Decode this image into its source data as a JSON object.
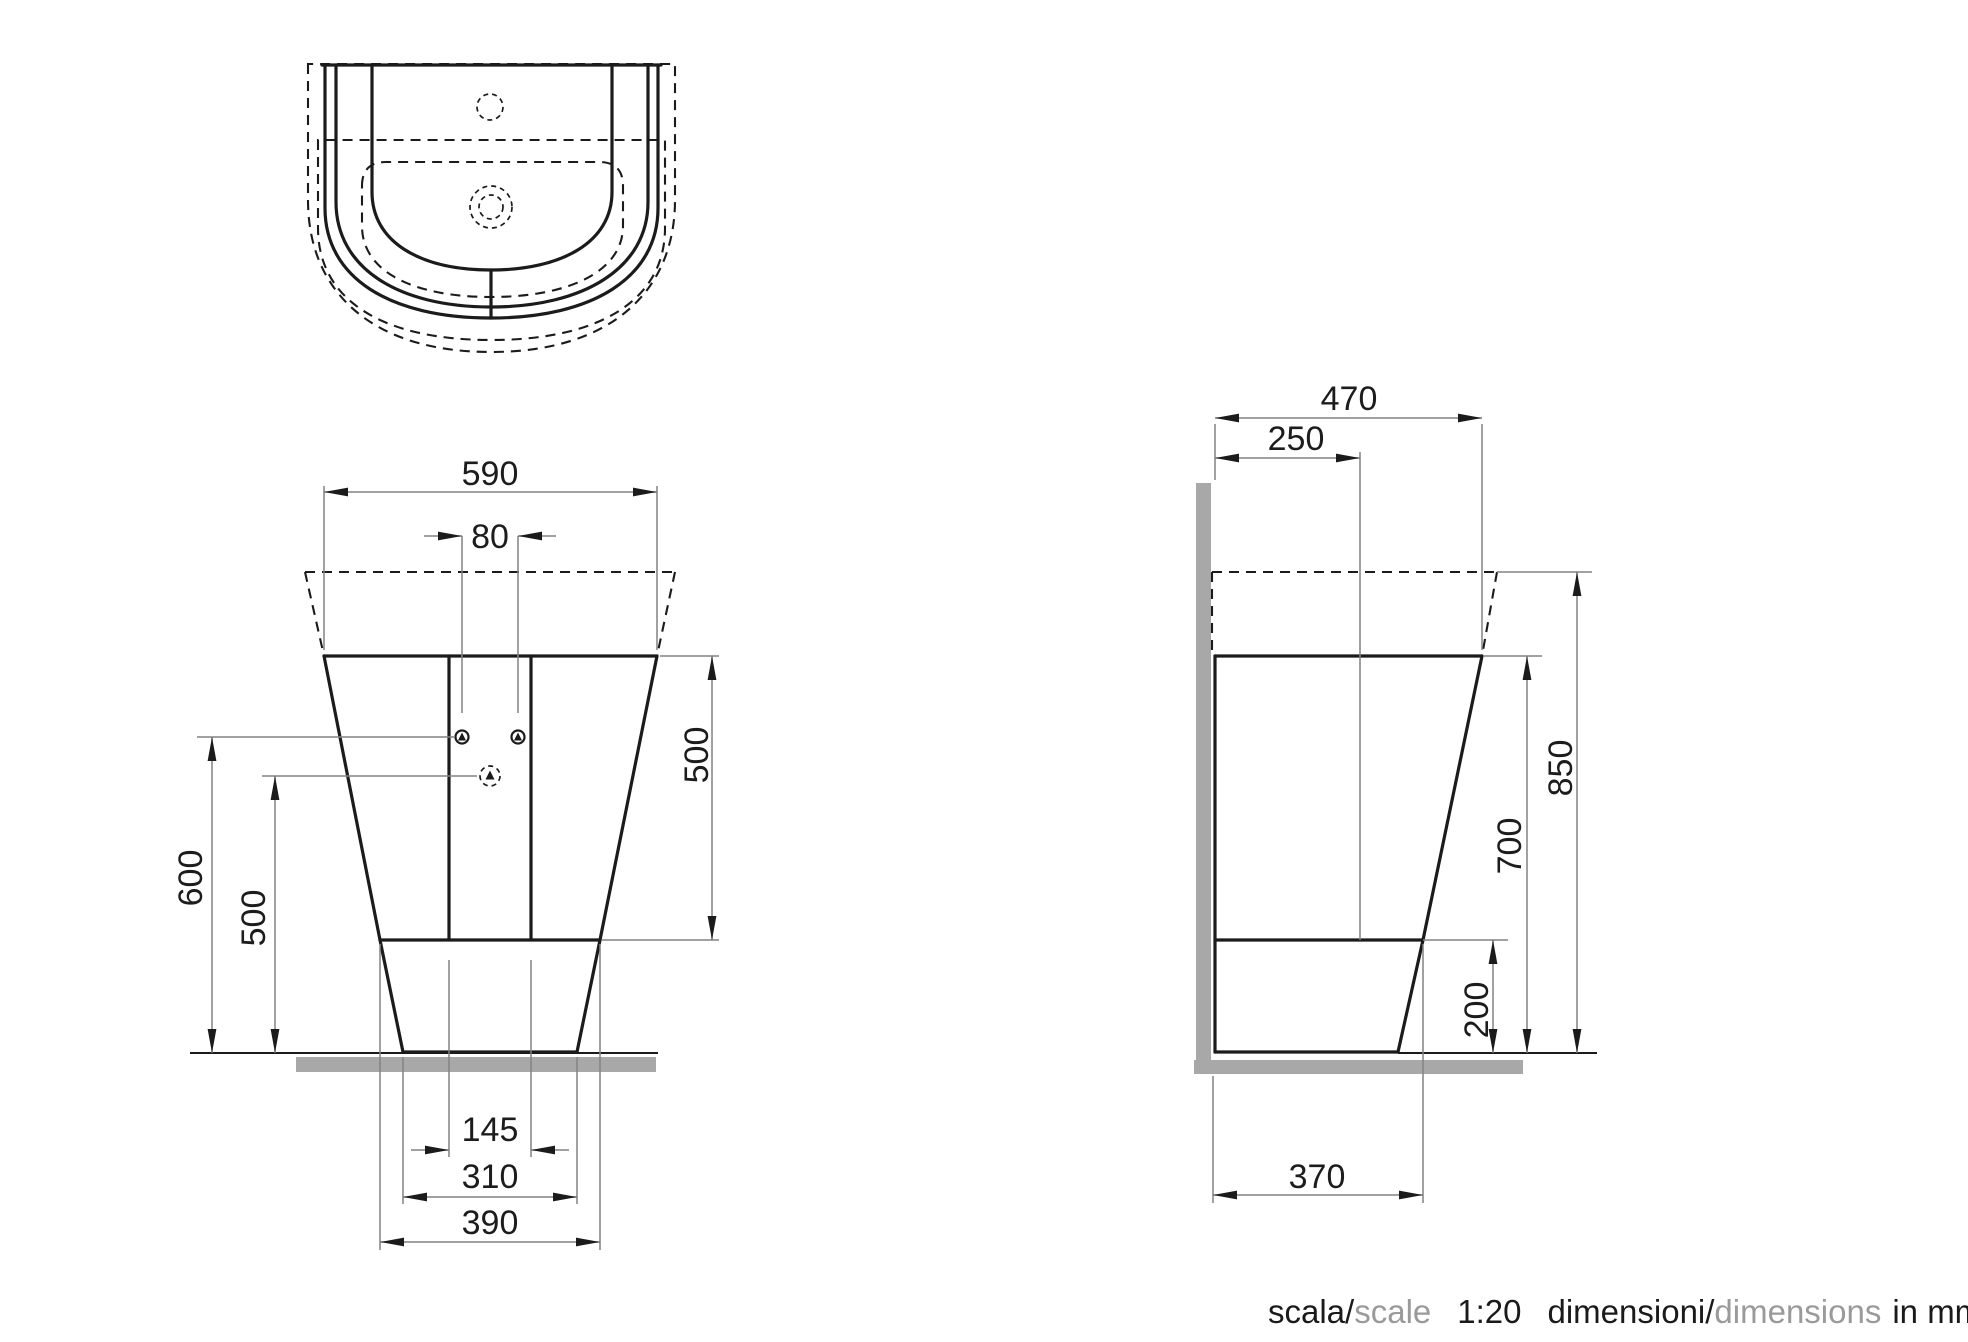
{
  "front_view": {
    "dim_590": "590",
    "dim_80": "80",
    "dim_500_right": "500",
    "dim_600": "600",
    "dim_500_left": "500",
    "dim_145": "145",
    "dim_310": "310",
    "dim_390": "390"
  },
  "side_view": {
    "dim_470": "470",
    "dim_250": "250",
    "dim_850": "850",
    "dim_700": "700",
    "dim_200": "200",
    "dim_370": "370"
  },
  "caption": {
    "scala": "scala/",
    "scale": "scale",
    "ratio": "1:20",
    "dimensioni": "dimensioni/",
    "dimensions": "dimensions",
    "unit": "in mm"
  },
  "colors": {
    "line": "#1b1b1b",
    "dim_line": "#828282",
    "gray_fill": "#a8a8a8",
    "caption_gray": "#9a9a9a"
  }
}
